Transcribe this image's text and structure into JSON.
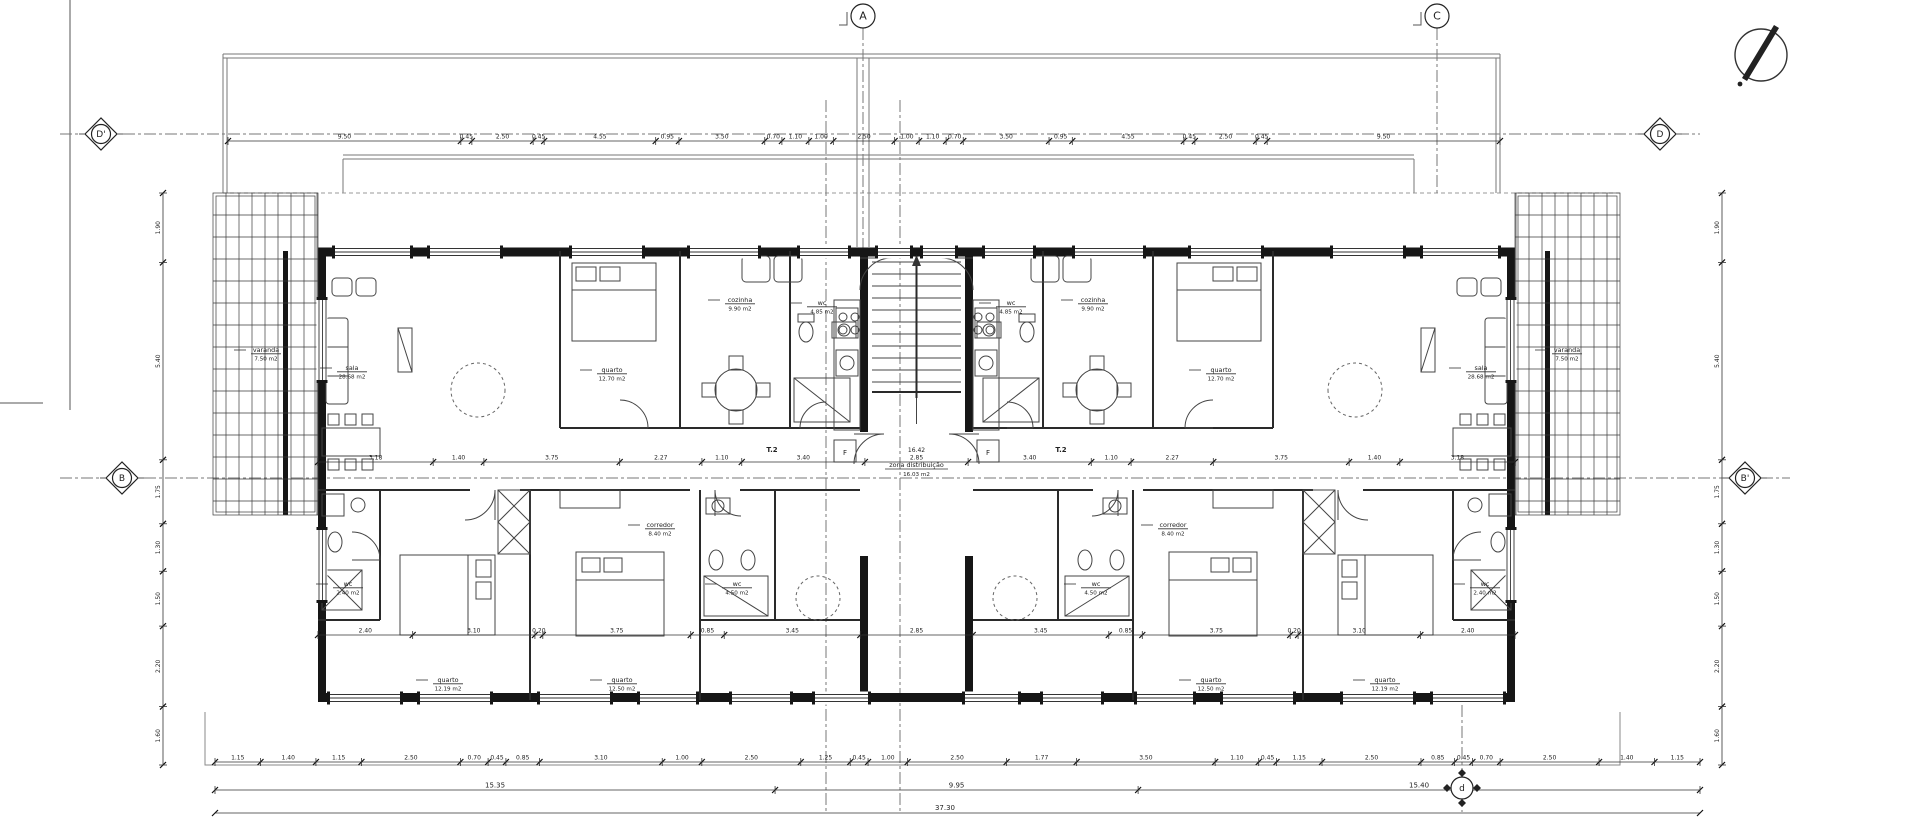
{
  "drawing_type": "apartment floor plan",
  "axes": {
    "top": [
      {
        "label": "A"
      },
      {
        "label": "C"
      }
    ],
    "left": [
      {
        "label": "D'"
      },
      {
        "label": "B"
      }
    ],
    "right": [
      {
        "label": "D"
      },
      {
        "label": "B'"
      }
    ],
    "bottom": [
      {
        "label": "d"
      }
    ]
  },
  "unit_type_label": "T.2",
  "core": {
    "name": "zona distribuição",
    "area": "16.03 m2",
    "dim": "16.42"
  },
  "fridge_label": "F",
  "rooms": [
    {
      "id": "sala",
      "name": "sala",
      "area": "28.68 m2"
    },
    {
      "id": "quarto-top",
      "name": "quarto",
      "area": "12.70 m2"
    },
    {
      "id": "cozinha",
      "name": "cozinha",
      "area": "9.90 m2"
    },
    {
      "id": "wc-top",
      "name": "wc",
      "area": "4.85 m2"
    },
    {
      "id": "corredor",
      "name": "corredor",
      "area": "8.40 m2"
    },
    {
      "id": "quarto-b1",
      "name": "quarto",
      "area": "12.19 m2"
    },
    {
      "id": "quarto-b2",
      "name": "quarto",
      "area": "12.50 m2"
    },
    {
      "id": "wc-b",
      "name": "wc",
      "area": "4.50 m2"
    },
    {
      "id": "wc-small",
      "name": "wc",
      "area": "2.40 m2"
    },
    {
      "id": "varanda",
      "name": "varanda",
      "area": "7.50 m2"
    }
  ],
  "dims": {
    "top": [
      "9.50",
      "0.45",
      "2.50",
      "0.45",
      "4.55",
      "0.95",
      "3.50",
      "0.70",
      "1.10",
      "1.00",
      "2.50",
      "1.00",
      "1.10",
      "0.70",
      "3.50",
      "0.95",
      "4.55",
      "0.45",
      "2.50",
      "0.45",
      "9.50"
    ],
    "corridor": [
      "3.18",
      "1.40",
      "3.75",
      "2.27",
      "1.10",
      "3.40",
      "2.85",
      "3.40",
      "1.10",
      "2.27",
      "3.75",
      "1.40",
      "3.18"
    ],
    "lower": [
      "2.40",
      "3.10",
      "0.20",
      "3.75",
      "0.85",
      "3.45",
      "2.85",
      "3.45",
      "0.85",
      "3.75",
      "0.20",
      "3.10",
      "2.40"
    ],
    "bottom_detail": [
      "1.15",
      "1.40",
      "1.15",
      "2.50",
      "0.70",
      "0.45",
      "0.85",
      "3.10",
      "1.00",
      "2.50",
      "1.25",
      "0.45",
      "1.00",
      "2.50",
      "1.77",
      "3.50",
      "1.10",
      "0.45",
      "1.15",
      "2.50",
      "0.85",
      "0.45",
      "0.70",
      "2.50",
      "1.40",
      "1.15"
    ],
    "bottom_totals": [
      "15.35",
      "9.95",
      "15.40"
    ],
    "bottom_overall": "37.30",
    "left_side": [
      "1.90",
      "5.40",
      "1.75",
      "1.30",
      "1.50",
      "2.20",
      "1.60"
    ],
    "right_side": [
      "1.90",
      "5.40",
      "1.75",
      "1.30",
      "1.50",
      "2.20",
      "1.60"
    ]
  },
  "colors": {
    "wall": "#161616",
    "line": "#444444",
    "axis": "#777777"
  }
}
